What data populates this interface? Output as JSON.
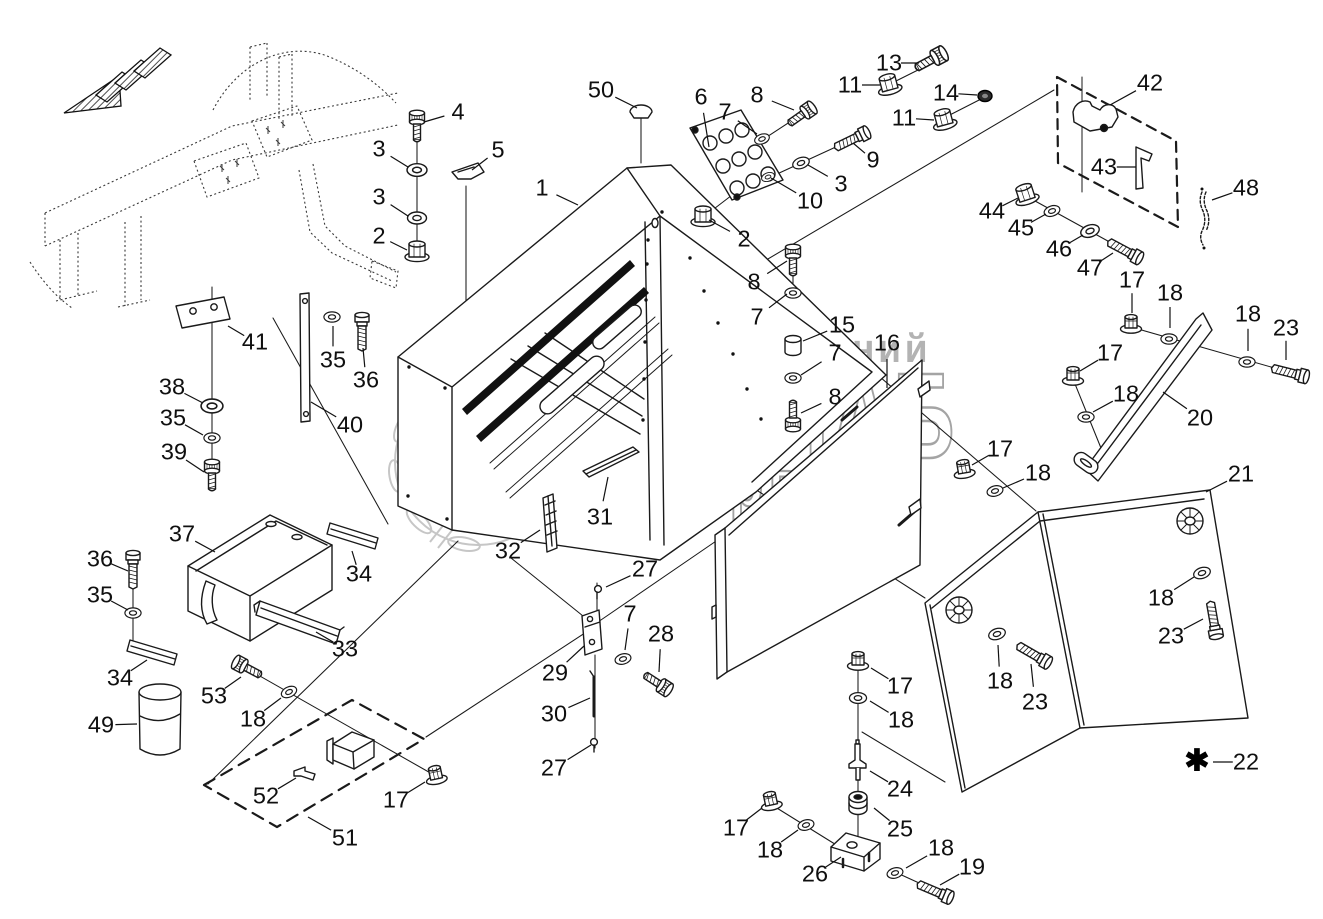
{
  "watermark": {
    "line1": "группа компаний",
    "line2": "АГРОСНАБ",
    "line3": "техсервис"
  },
  "note": {
    "symbol": "✱",
    "x": 1197,
    "y": 761
  },
  "callouts": [
    {
      "n": "50",
      "x": 601,
      "y": 90,
      "tx": 637,
      "ty": 108
    },
    {
      "n": "4",
      "x": 458,
      "y": 112,
      "tx": 424,
      "ty": 122
    },
    {
      "n": "3",
      "x": 379,
      "y": 149,
      "tx": 408,
      "ty": 167
    },
    {
      "n": "3",
      "x": 379,
      "y": 197,
      "tx": 408,
      "ty": 216
    },
    {
      "n": "2",
      "x": 379,
      "y": 236,
      "tx": 407,
      "ty": 250
    },
    {
      "n": "5",
      "x": 498,
      "y": 150,
      "tx": 472,
      "ty": 170
    },
    {
      "n": "1",
      "x": 542,
      "y": 188,
      "tx": 578,
      "ty": 205
    },
    {
      "n": "6",
      "x": 701,
      "y": 97,
      "tx": 709,
      "ty": 147
    },
    {
      "n": "7",
      "x": 725,
      "y": 112,
      "tx": 757,
      "ty": 134
    },
    {
      "n": "8",
      "x": 757,
      "y": 95,
      "tx": 794,
      "ty": 110
    },
    {
      "n": "9",
      "x": 873,
      "y": 160,
      "tx": 853,
      "ty": 143
    },
    {
      "n": "3",
      "x": 841,
      "y": 184,
      "tx": 808,
      "ty": 165
    },
    {
      "n": "10",
      "x": 810,
      "y": 201,
      "tx": 771,
      "ty": 178
    },
    {
      "n": "2",
      "x": 744,
      "y": 239,
      "tx": 709,
      "ty": 220
    },
    {
      "n": "13",
      "x": 889,
      "y": 63,
      "tx": 919,
      "ty": 63
    },
    {
      "n": "11",
      "x": 850,
      "y": 85,
      "tx": 880,
      "ty": 85
    },
    {
      "n": "14",
      "x": 946,
      "y": 93,
      "tx": 977,
      "ty": 95
    },
    {
      "n": "11",
      "x": 904,
      "y": 118,
      "tx": 934,
      "ty": 120
    },
    {
      "n": "42",
      "x": 1150,
      "y": 83,
      "tx": 1110,
      "ty": 105
    },
    {
      "n": "43",
      "x": 1104,
      "y": 167,
      "tx": 1136,
      "ty": 167
    },
    {
      "n": "48",
      "x": 1246,
      "y": 188,
      "tx": 1212,
      "ty": 200
    },
    {
      "n": "44",
      "x": 992,
      "y": 211,
      "tx": 1018,
      "ty": 198
    },
    {
      "n": "45",
      "x": 1021,
      "y": 228,
      "tx": 1046,
      "ty": 214
    },
    {
      "n": "46",
      "x": 1059,
      "y": 249,
      "tx": 1083,
      "ty": 235
    },
    {
      "n": "47",
      "x": 1090,
      "y": 268,
      "tx": 1113,
      "ty": 253
    },
    {
      "n": "8",
      "x": 754,
      "y": 282,
      "tx": 787,
      "ty": 261
    },
    {
      "n": "7",
      "x": 757,
      "y": 317,
      "tx": 787,
      "ty": 294
    },
    {
      "n": "15",
      "x": 842,
      "y": 325,
      "tx": 803,
      "ty": 341
    },
    {
      "n": "7",
      "x": 835,
      "y": 353,
      "tx": 801,
      "ty": 375
    },
    {
      "n": "8",
      "x": 835,
      "y": 397,
      "tx": 801,
      "ty": 413
    },
    {
      "n": "16",
      "x": 887,
      "y": 343,
      "tx": 887,
      "ty": 388
    },
    {
      "n": "17",
      "x": 1000,
      "y": 449,
      "tx": 972,
      "ty": 465
    },
    {
      "n": "18",
      "x": 1038,
      "y": 473,
      "tx": 1003,
      "ty": 488
    },
    {
      "n": "17",
      "x": 1110,
      "y": 353,
      "tx": 1080,
      "ty": 371
    },
    {
      "n": "18",
      "x": 1126,
      "y": 394,
      "tx": 1093,
      "ty": 412
    },
    {
      "n": "17",
      "x": 1132,
      "y": 280,
      "tx": 1132,
      "ty": 313
    },
    {
      "n": "18",
      "x": 1170,
      "y": 293,
      "tx": 1170,
      "ty": 328
    },
    {
      "n": "18",
      "x": 1248,
      "y": 314,
      "tx": 1248,
      "ty": 351
    },
    {
      "n": "23",
      "x": 1286,
      "y": 328,
      "tx": 1286,
      "ty": 360
    },
    {
      "n": "20",
      "x": 1200,
      "y": 418,
      "tx": 1163,
      "ty": 392
    },
    {
      "n": "21",
      "x": 1241,
      "y": 474,
      "tx": 1206,
      "ty": 492
    },
    {
      "n": "18",
      "x": 1161,
      "y": 598,
      "tx": 1194,
      "ty": 577
    },
    {
      "n": "23",
      "x": 1171,
      "y": 636,
      "tx": 1203,
      "ty": 619
    },
    {
      "n": "18",
      "x": 1000,
      "y": 681,
      "tx": 998,
      "ty": 645
    },
    {
      "n": "23",
      "x": 1035,
      "y": 702,
      "tx": 1031,
      "ty": 664
    },
    {
      "n": "22",
      "x": 1246,
      "y": 762,
      "tx": 1213,
      "ty": 762
    },
    {
      "n": "27",
      "x": 645,
      "y": 569,
      "tx": 606,
      "ty": 587
    },
    {
      "n": "7",
      "x": 630,
      "y": 614,
      "tx": 625,
      "ty": 650
    },
    {
      "n": "28",
      "x": 661,
      "y": 634,
      "tx": 659,
      "ty": 672
    },
    {
      "n": "29",
      "x": 555,
      "y": 673,
      "tx": 584,
      "ty": 646
    },
    {
      "n": "30",
      "x": 554,
      "y": 714,
      "tx": 590,
      "ty": 698
    },
    {
      "n": "27",
      "x": 554,
      "y": 768,
      "tx": 591,
      "ty": 745
    },
    {
      "n": "17",
      "x": 900,
      "y": 686,
      "tx": 871,
      "ty": 668
    },
    {
      "n": "18",
      "x": 901,
      "y": 720,
      "tx": 870,
      "ty": 701
    },
    {
      "n": "24",
      "x": 900,
      "y": 789,
      "tx": 870,
      "ty": 771
    },
    {
      "n": "25",
      "x": 900,
      "y": 829,
      "tx": 874,
      "ty": 808
    },
    {
      "n": "26",
      "x": 815,
      "y": 874,
      "tx": 841,
      "ty": 857
    },
    {
      "n": "17",
      "x": 736,
      "y": 828,
      "tx": 762,
      "ty": 808
    },
    {
      "n": "18",
      "x": 770,
      "y": 850,
      "tx": 798,
      "ty": 830
    },
    {
      "n": "18",
      "x": 941,
      "y": 848,
      "tx": 906,
      "ty": 868
    },
    {
      "n": "19",
      "x": 972,
      "y": 867,
      "tx": 940,
      "ty": 885
    },
    {
      "n": "41",
      "x": 255,
      "y": 342,
      "tx": 228,
      "ty": 326
    },
    {
      "n": "38",
      "x": 172,
      "y": 387,
      "tx": 203,
      "ty": 403
    },
    {
      "n": "35",
      "x": 173,
      "y": 418,
      "tx": 203,
      "ty": 435
    },
    {
      "n": "39",
      "x": 174,
      "y": 452,
      "tx": 204,
      "ty": 472
    },
    {
      "n": "35",
      "x": 333,
      "y": 360,
      "tx": 333,
      "ty": 326
    },
    {
      "n": "36",
      "x": 366,
      "y": 380,
      "tx": 363,
      "ty": 348
    },
    {
      "n": "40",
      "x": 350,
      "y": 425,
      "tx": 311,
      "ty": 402
    },
    {
      "n": "37",
      "x": 182,
      "y": 534,
      "tx": 215,
      "ty": 552
    },
    {
      "n": "34",
      "x": 359,
      "y": 574,
      "tx": 352,
      "ty": 551
    },
    {
      "n": "36",
      "x": 100,
      "y": 559,
      "tx": 128,
      "ty": 571
    },
    {
      "n": "35",
      "x": 100,
      "y": 595,
      "tx": 128,
      "ty": 610
    },
    {
      "n": "34",
      "x": 120,
      "y": 678,
      "tx": 147,
      "ty": 660
    },
    {
      "n": "49",
      "x": 101,
      "y": 725,
      "tx": 137,
      "ty": 724
    },
    {
      "n": "53",
      "x": 214,
      "y": 696,
      "tx": 241,
      "ty": 677
    },
    {
      "n": "18",
      "x": 253,
      "y": 719,
      "tx": 281,
      "ty": 698
    },
    {
      "n": "52",
      "x": 266,
      "y": 796,
      "tx": 296,
      "ty": 778
    },
    {
      "n": "51",
      "x": 345,
      "y": 838,
      "tx": 308,
      "ty": 817
    },
    {
      "n": "17",
      "x": 396,
      "y": 800,
      "tx": 425,
      "ty": 782
    },
    {
      "n": "33",
      "x": 345,
      "y": 649,
      "tx": 316,
      "ty": 632
    },
    {
      "n": "31",
      "x": 600,
      "y": 517,
      "tx": 608,
      "ty": 477
    },
    {
      "n": "32",
      "x": 508,
      "y": 551,
      "tx": 540,
      "ty": 530
    }
  ]
}
